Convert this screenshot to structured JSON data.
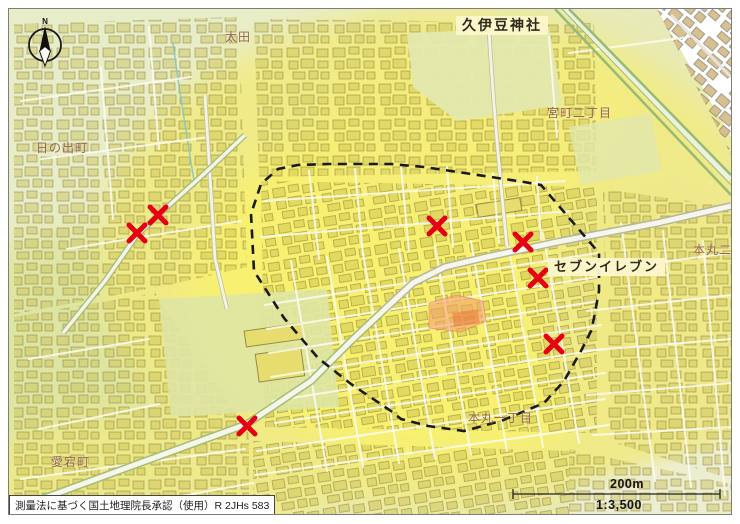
{
  "map": {
    "attribution": "測量法に基づく国土地理院長承認（使用）R 2JHs 583",
    "compass": {
      "label": "N"
    },
    "scale": {
      "distance_label": "200m",
      "ratio_label": "1:3,500"
    },
    "labels": [
      {
        "id": "hisaizu-jinja",
        "text": "久伊豆神社"
      },
      {
        "id": "seven-eleven",
        "text": "セブンイレブン"
      },
      {
        "id": "ota",
        "text": "太田"
      },
      {
        "id": "hinode-cho",
        "text": "日の出町"
      },
      {
        "id": "miyacho-2chome",
        "text": "宮町二丁目"
      },
      {
        "id": "honmaru-2chome",
        "text": "本丸二丁目"
      },
      {
        "id": "honmaru-1chome",
        "text": "本丸一丁目"
      },
      {
        "id": "atago-cho",
        "text": "愛宕町"
      }
    ],
    "markers": [
      {
        "transform": "translate(149,206)"
      },
      {
        "transform": "translate(128,224)"
      },
      {
        "transform": "translate(238,417)"
      },
      {
        "transform": "translate(428,217)"
      },
      {
        "transform": "translate(514,233)"
      },
      {
        "transform": "translate(529,269)"
      },
      {
        "transform": "translate(545,335)"
      }
    ],
    "boundary": {
      "points": "242,205 245,262 275,309 309,349 342,375 382,402 392,410 419,417 455,422 492,412 535,394 555,372 572,342 582,322 585,309 590,282 590,244 532,176 515,173 482,168 449,163 415,158 382,155 352,155 319,155 289,156 269,160 252,175"
    },
    "highlight": {
      "points": "420,294 447,286 474,292 477,312 452,323 420,319"
    },
    "colors": {
      "marker_red": "#e60012",
      "boundary_black": "#1a1a1a",
      "highlight_orange": "#f3a06c",
      "flood_yellow": "#f7f173",
      "base_green": "#e7eab8",
      "label_brown": "#95674a"
    }
  }
}
